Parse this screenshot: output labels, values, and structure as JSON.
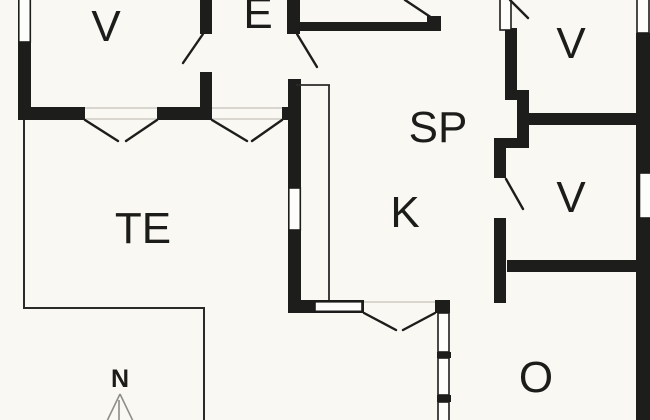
{
  "plan": {
    "type": "floor-plan",
    "background_color": "#f9f8f3",
    "wall_color": "#1d1d1b",
    "threshold_color": "#d8d6cf",
    "compass_arrow_color": "#8f8d88",
    "rooms": [
      {
        "id": "v-top-left",
        "label": "V"
      },
      {
        "id": "entry",
        "label": "E"
      },
      {
        "id": "sp-dining",
        "label": "SP"
      },
      {
        "id": "k-kitchen",
        "label": "K"
      },
      {
        "id": "v-upper-right",
        "label": "V"
      },
      {
        "id": "v-lower-right",
        "label": "V"
      },
      {
        "id": "te-terrace",
        "label": "TE"
      },
      {
        "id": "o-living",
        "label": "O"
      }
    ],
    "compass": {
      "label": "N"
    }
  }
}
